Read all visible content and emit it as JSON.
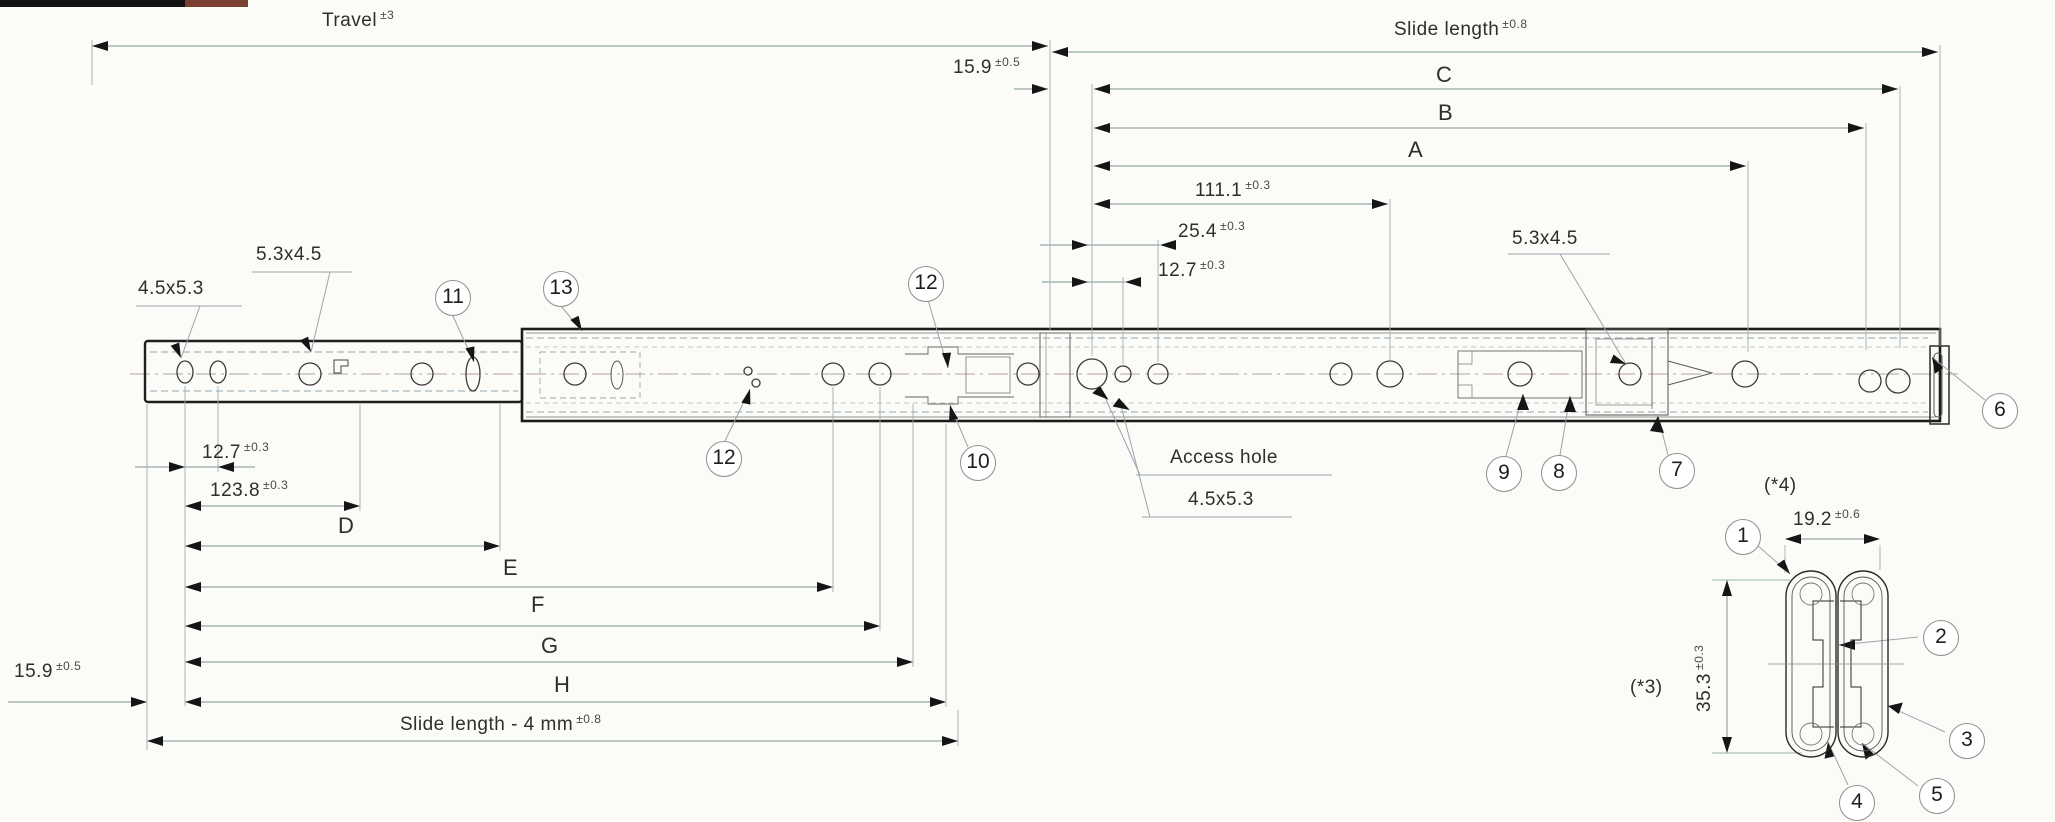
{
  "dims": {
    "travel": {
      "value": "Travel",
      "tol": "±3"
    },
    "slide_length": {
      "value": "Slide length",
      "tol": "±0.8"
    },
    "top_159": {
      "value": "15.9",
      "tol": "±0.5"
    },
    "c": "C",
    "b": "B",
    "a": "A",
    "d111": {
      "value": "111.1",
      "tol": "±0.3"
    },
    "d254": {
      "value": "25.4",
      "tol": "±0.3"
    },
    "d127_top": {
      "value": "12.7",
      "tol": "±0.3"
    },
    "hole_4553_left": "4.5x5.3",
    "hole_5345_left": "5.3x4.5",
    "hole_5345_right": "5.3x4.5",
    "d127_bottom": {
      "value": "12.7",
      "tol": "±0.3"
    },
    "d1238": {
      "value": "123.8",
      "tol": "±0.3"
    },
    "d": "D",
    "e": "E",
    "f": "F",
    "g": "G",
    "h": "H",
    "bottom_159": {
      "value": "15.9",
      "tol": "±0.5"
    },
    "slide_length_minus": {
      "value": "Slide length - 4 mm",
      "tol": "±0.8"
    },
    "access_hole": "Access hole",
    "hole_4553_right": "4.5x5.3",
    "star4": "(*4)",
    "d192": {
      "value": "19.2",
      "tol": "±0.6"
    },
    "d353": {
      "value": "35.3",
      "tol": "±0.3"
    },
    "star3": "(*3)"
  },
  "balloons": {
    "b1": "1",
    "b2": "2",
    "b3": "3",
    "b4": "4",
    "b5": "5",
    "b6": "6",
    "b7": "7",
    "b8": "8",
    "b9": "9",
    "b10": "10",
    "b11": "11",
    "b12a": "12",
    "b12b": "12",
    "b13": "13"
  }
}
